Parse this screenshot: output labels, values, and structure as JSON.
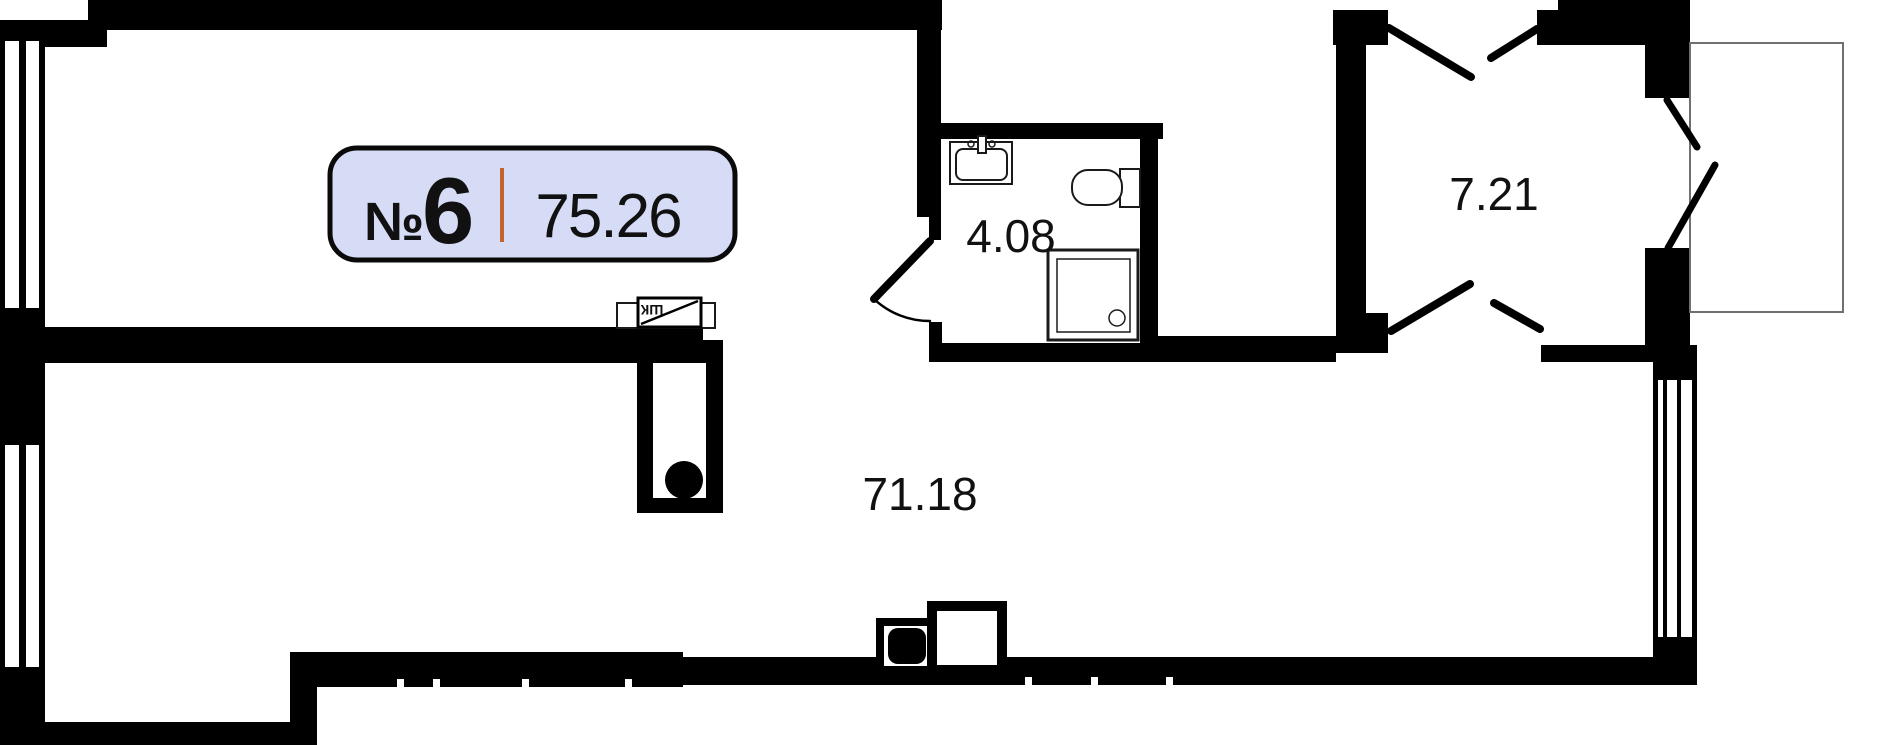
{
  "floor_plan": {
    "badge": {
      "number_sign": "№",
      "number": "6",
      "area": "75.26",
      "fill": "#d6dbf6",
      "border_color": "#0a0a0a",
      "divider_color": "#c2622d"
    },
    "labels": {
      "bathroom_area": "4.08",
      "hallway_area": "7.21",
      "main_area": "71.18",
      "wardrobe": "ШК"
    },
    "colors": {
      "wall": "#000000",
      "background": "#ffffff",
      "text": "#111111",
      "balcony_line": "#707070",
      "fixture_line": "#1a1a1a"
    },
    "icons": [
      "sink-icon",
      "toilet-icon",
      "shower-icon",
      "washer-box-icon",
      "vent-shaft-icon",
      "wardrobe-icon",
      "door-swing-icon",
      "window-icon"
    ]
  }
}
